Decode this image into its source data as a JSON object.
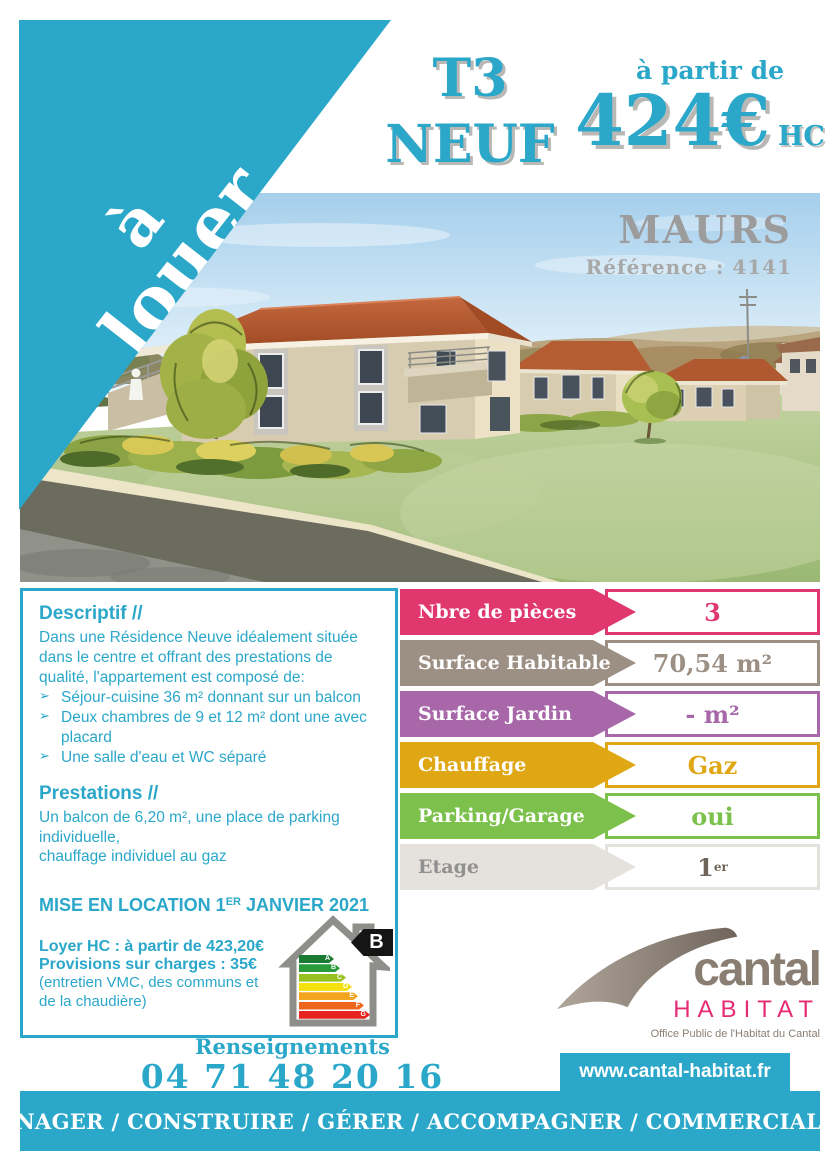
{
  "ribbon": {
    "word1": "à",
    "word2": "louer"
  },
  "header": {
    "unit_type": "T3",
    "unit_state": "NEUF",
    "price_intro": "à partir de",
    "price_amount": "424€",
    "price_unit": "HC"
  },
  "photo": {
    "city": "MAURS",
    "reference": "Référence : 4141"
  },
  "descriptif": {
    "title": "Descriptif //",
    "intro": "Dans une Résidence Neuve idéalement située  dans le centre et offrant des prestations de qualité, l'appartement est composé de:",
    "bullet_icon": "➢",
    "bullets": [
      "Séjour-cuisine  36 m² donnant sur un balcon",
      "Deux chambres de 9 et 12 m²  dont une avec placard",
      "Une salle d'eau et  WC séparé"
    ],
    "prestations_title": "Prestations //",
    "prestations_text": "Un balcon de 6,20 m², une place de parking individuelle,\nchauffage individuel au gaz",
    "availability": {
      "pre": "MISE EN LOCATION 1",
      "sup": "ER",
      "post": " JANVIER 2021"
    },
    "rent_line": "Loyer HC :  à partir de 423,20€",
    "charges_line": "Provisions sur charges : 35€",
    "charges_note": "(entretien VMC, des communs et\nde la chaudière)",
    "energy": {
      "rating": "B",
      "scale": [
        {
          "letter": "A",
          "color": "#1b7a32"
        },
        {
          "letter": "B",
          "color": "#2a9b3b"
        },
        {
          "letter": "C",
          "color": "#97c021"
        },
        {
          "letter": "D",
          "color": "#f3e00d"
        },
        {
          "letter": "E",
          "color": "#f4a51f"
        },
        {
          "letter": "F",
          "color": "#ec671c"
        },
        {
          "letter": "G",
          "color": "#e6231e"
        }
      ]
    }
  },
  "attributes": [
    {
      "label": "Nbre de pièces",
      "value": "3",
      "color": "#e0376f"
    },
    {
      "label": "Surface Habitable",
      "value": "70,54 m²",
      "color": "#9c8f84"
    },
    {
      "label": "Surface Jardin",
      "value": "- m²",
      "color": "#a767a8"
    },
    {
      "label": "Chauffage",
      "value": "Gaz",
      "color": "#dfa713"
    },
    {
      "label": "Parking/Garage",
      "value": "oui",
      "color": "#7cc14b"
    },
    {
      "label": "Etage",
      "value": "1",
      "value_sup": "er",
      "color": "#e5e2dd",
      "label_color": "#909090",
      "value_color": "#6f6459"
    }
  ],
  "contact": {
    "label": "Renseignements",
    "phone": "04 71 48 20 16"
  },
  "logo": {
    "word": "cantal",
    "word2": "HABITAT",
    "tagline": "Office Public de l'Habitat du Cantal"
  },
  "website": {
    "url": "www.cantal-habitat.fr"
  },
  "footer": {
    "banner": "AMÉNAGER / CONSTRUIRE / GÉRER / ACCOMPAGNER / COMMERCIALISER"
  },
  "colors": {
    "teal": "#2aa7c9",
    "logo_taupe": "#8a7e73",
    "logo_pink": "#e62b72",
    "title_gray": "#9c9c9c"
  }
}
